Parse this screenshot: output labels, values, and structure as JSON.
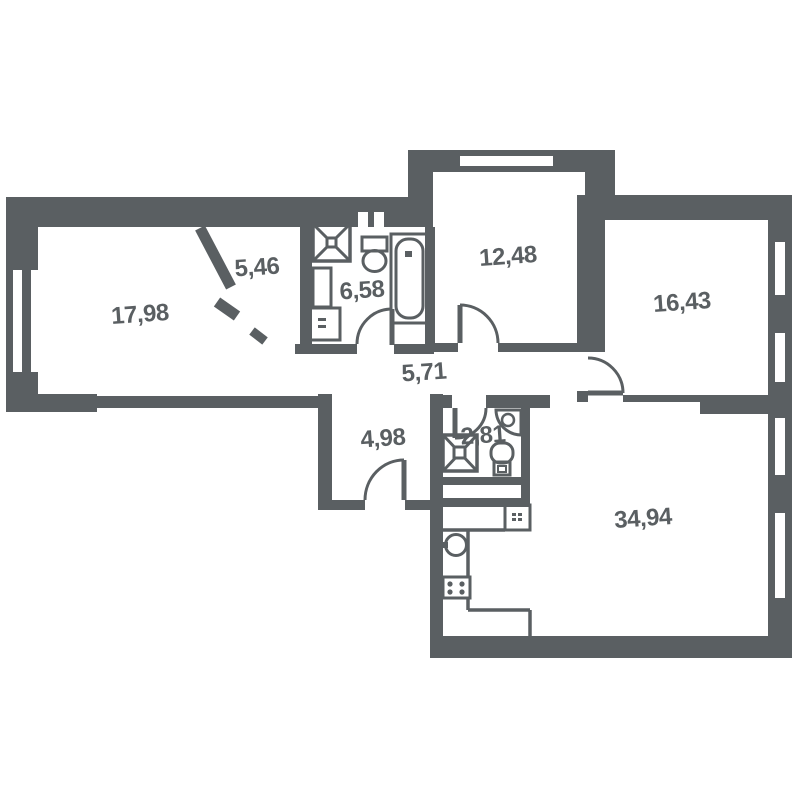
{
  "plan": {
    "type": "apartment-floor-plan",
    "wall_color": "#5a5f62",
    "background_color": "#ffffff",
    "label_color": "#5a5f62"
  },
  "rooms": [
    {
      "name": "bedroom-left",
      "area": "17,98"
    },
    {
      "name": "wardrobe",
      "area": "5,46"
    },
    {
      "name": "bathroom",
      "area": "6,58"
    },
    {
      "name": "bedroom-top",
      "area": "12,48"
    },
    {
      "name": "bedroom-right",
      "area": "16,43"
    },
    {
      "name": "hallway",
      "area": "5,71"
    },
    {
      "name": "entry-hall",
      "area": "4,98"
    },
    {
      "name": "wc",
      "area": "2,81"
    },
    {
      "name": "living-kitchen",
      "area": "34,94"
    }
  ],
  "fixtures": [
    "shower-cabin",
    "toilet",
    "bathtub",
    "cabinet",
    "washing-machine",
    "corner-sink",
    "wc-toilet",
    "wc-shower-cabin",
    "kitchen-sink",
    "stove",
    "kitchen-appliance",
    "kitchen-counter"
  ],
  "windows": [
    "window-left-wall",
    "window-top-bay",
    "window-right-1",
    "window-right-2",
    "window-right-3",
    "window-right-4"
  ],
  "doors": [
    "entrance-door",
    "bathroom-door",
    "wc-door",
    "bedroom-top-door",
    "bedroom-right-door",
    "wardrobe-diagonal-door"
  ]
}
